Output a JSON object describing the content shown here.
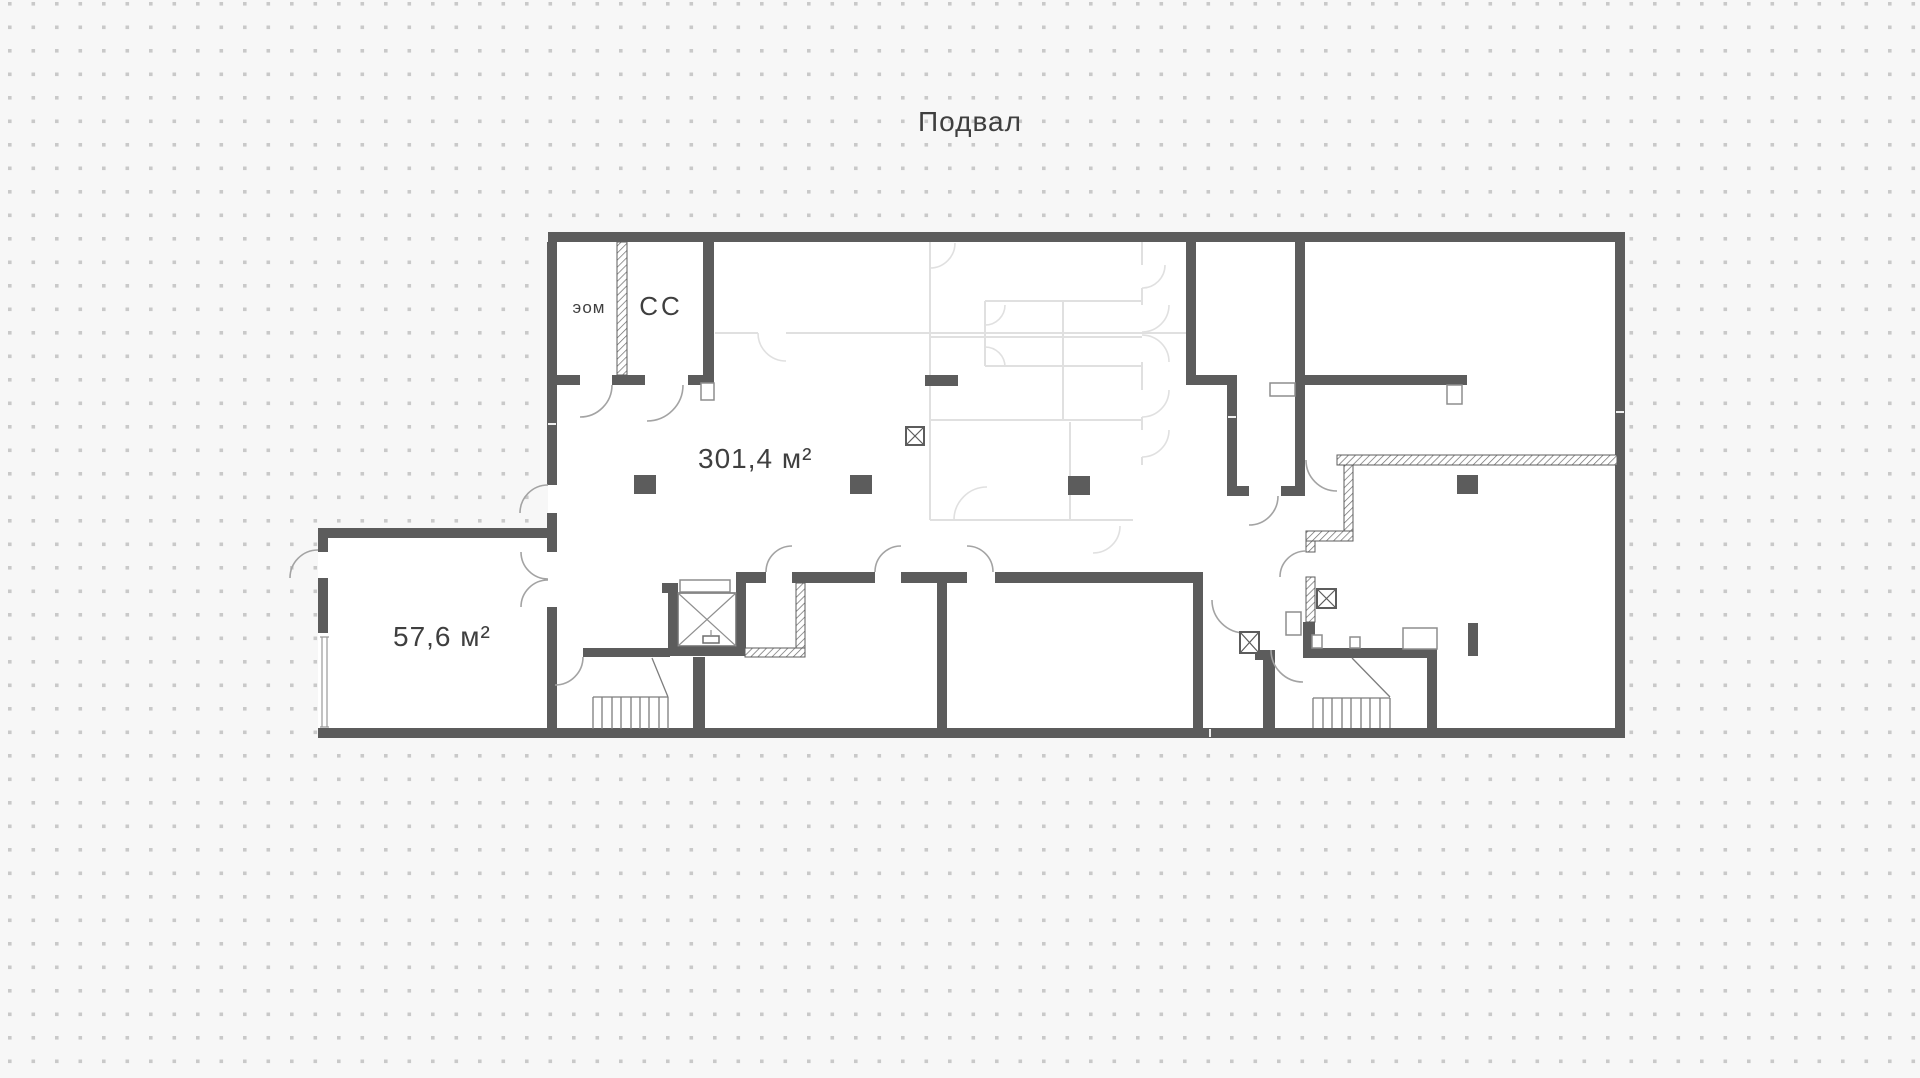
{
  "title": "Подвал",
  "labels": {
    "room_eom": "эом",
    "room_cc": "СС",
    "area_main": "301,4 м²",
    "area_annex": "57,6 м²"
  },
  "symbols": {
    "elevator": "elevator-shaft-with-x",
    "stairs_left": "staircase",
    "stairs_right": "staircase",
    "vent_shafts": [
      "crossed-box-shaft",
      "crossed-box-shaft",
      "crossed-box-shaft"
    ],
    "columns_count": 4
  },
  "colors": {
    "background": "#f7f7f7",
    "dots": "#c9c9c9",
    "wall": "#5c5c5c",
    "faded_partition": "#e0e0e0",
    "door_arc": "#a3a3a3",
    "text": "#3f3f3f"
  }
}
